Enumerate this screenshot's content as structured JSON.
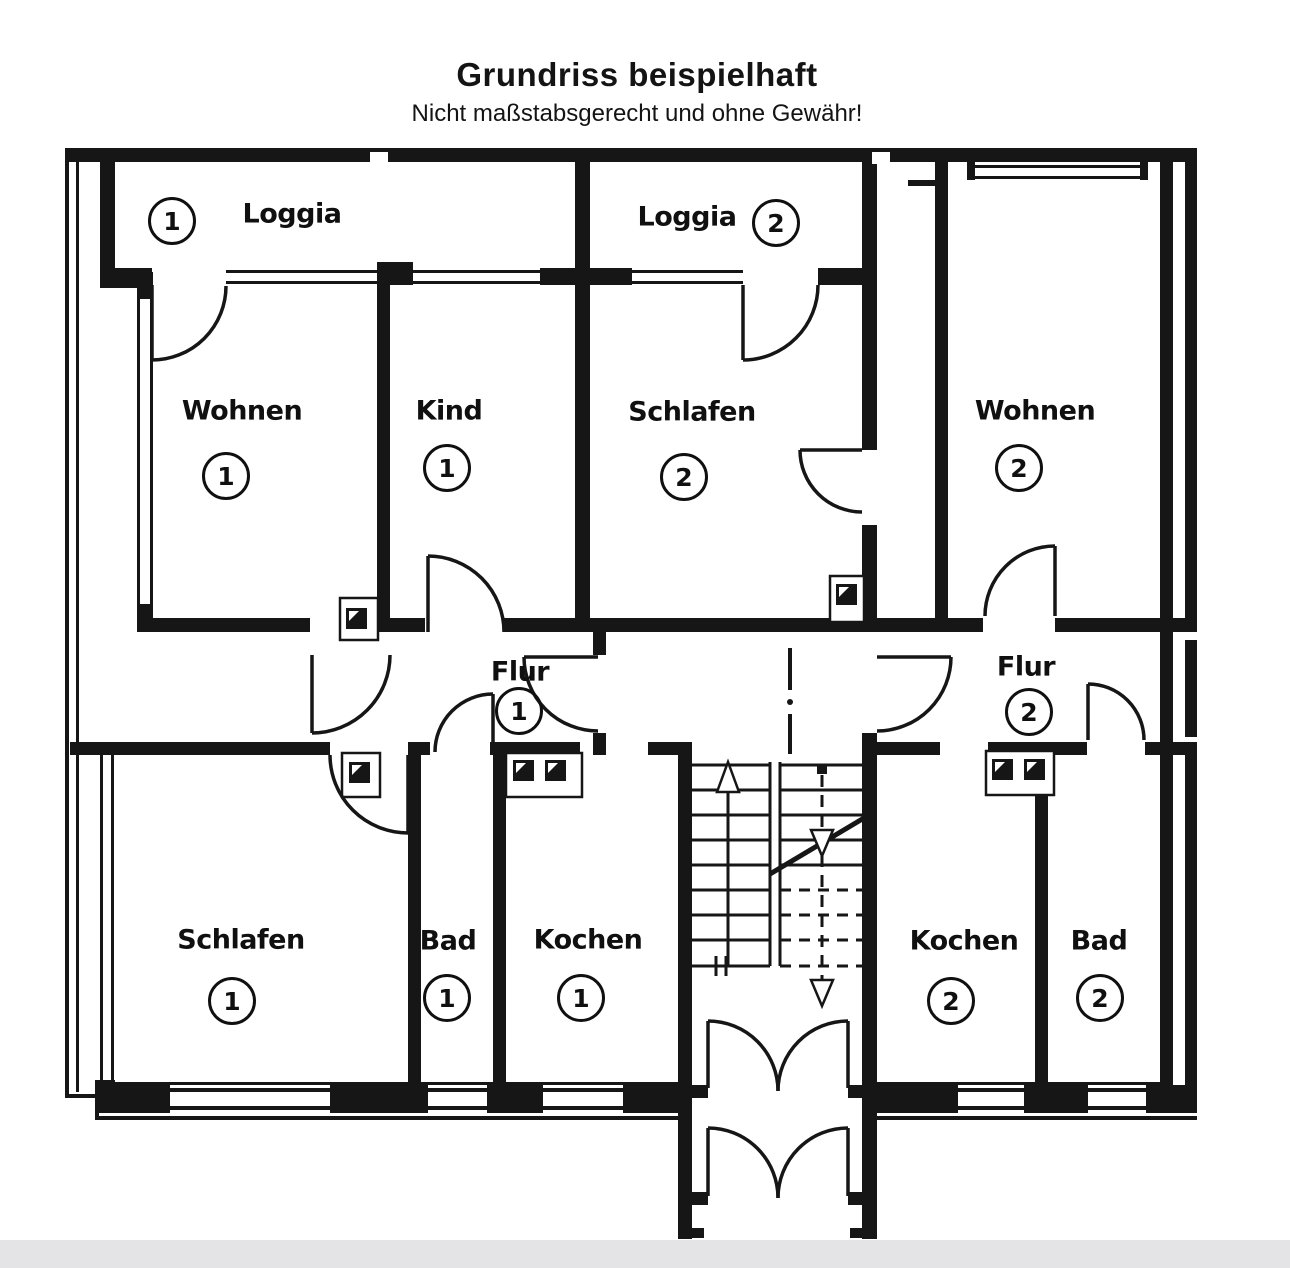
{
  "header": {
    "title": "Grundriss beispielhaft",
    "subtitle": "Nicht maßstabsgerecht und ohne Gewähr!"
  },
  "rooms": [
    {
      "id": "loggia-1",
      "name": "Loggia",
      "unit": "1"
    },
    {
      "id": "loggia-2",
      "name": "Loggia",
      "unit": "2"
    },
    {
      "id": "wohnen-1",
      "name": "Wohnen",
      "unit": "1"
    },
    {
      "id": "kind-1",
      "name": "Kind",
      "unit": "1"
    },
    {
      "id": "schlafen-2",
      "name": "Schlafen",
      "unit": "2"
    },
    {
      "id": "wohnen-2",
      "name": "Wohnen",
      "unit": "2"
    },
    {
      "id": "flur-1",
      "name": "Flur",
      "unit": "1"
    },
    {
      "id": "flur-2",
      "name": "Flur",
      "unit": "2"
    },
    {
      "id": "schlafen-1",
      "name": "Schlafen",
      "unit": "1"
    },
    {
      "id": "bad-1",
      "name": "Bad",
      "unit": "1"
    },
    {
      "id": "kochen-1",
      "name": "Kochen",
      "unit": "1"
    },
    {
      "id": "kochen-2",
      "name": "Kochen",
      "unit": "2"
    },
    {
      "id": "bad-2",
      "name": "Bad",
      "unit": "2"
    }
  ],
  "colors": {
    "ink": "#161616",
    "paper": "#ffffff",
    "footer_bar": "#e4e4e6"
  }
}
